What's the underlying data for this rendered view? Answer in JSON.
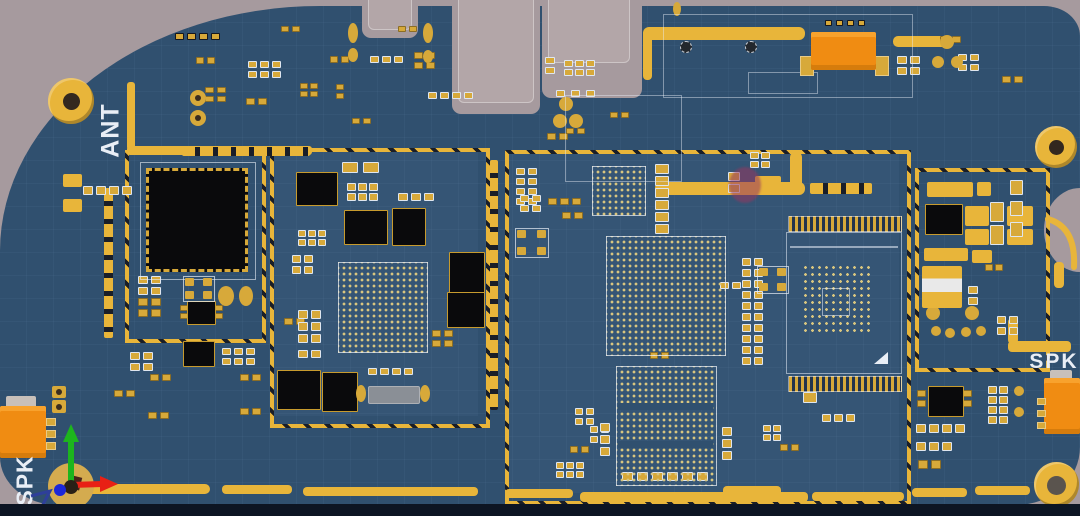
{
  "labels": {
    "antenna": "ANT",
    "speaker_left": "SPK",
    "speaker_right": "SPK"
  },
  "colors": {
    "background": "#a69a9e",
    "board_blue": "#30506f",
    "gold_trace": "#e8b53a",
    "pad_gold": "#d7a93a",
    "pad_outline_white": "#dfe6ef",
    "chip_black": "#0a0a0c",
    "connector_orange": "#f08c12",
    "connector_orange_light": "#f8a22d",
    "connector_orange_dark": "#d67c0c",
    "bottom_edge_dark": "#0d1523",
    "screw_hole_dark": "#33281f",
    "bga_dot": "#d9c67f",
    "axis_x_red": "#e82015",
    "axis_y_green": "#1db51d",
    "axis_z_blue": "#1c27d8",
    "marker_blue": "#2e3f9a",
    "component_gray": "#8a8f96",
    "connector_shell_gray": "#b3a6a8",
    "mic_purple": "#96375f"
  }
}
